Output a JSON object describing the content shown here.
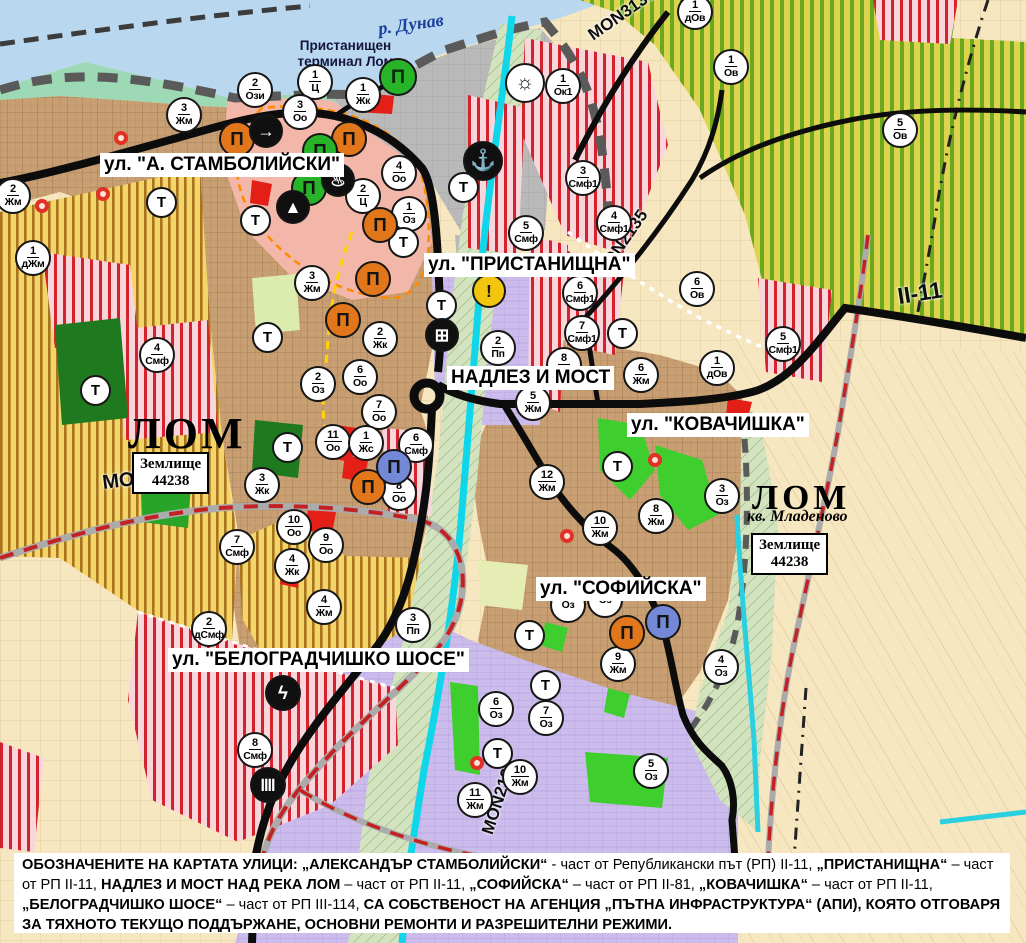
{
  "map": {
    "labels": {
      "river": "р. Дунав",
      "terminal": "Пристанищен\nтерминал Лом",
      "lom_left": "ЛОМ",
      "lom_right": "ЛОМ",
      "kvartal": "кв. Младеново"
    },
    "land_unit": {
      "line1": "Землище",
      "line2": "44238"
    },
    "land_unit_boxes": [
      {
        "x": 132,
        "y": 452
      },
      {
        "x": 751,
        "y": 533
      }
    ],
    "street_labels": [
      {
        "text": "ул. \"А. СТАМБОЛИЙСКИ\"",
        "x": 100,
        "y": 153
      },
      {
        "text": "ул. \"ПРИСТАНИЩНА\"",
        "x": 424,
        "y": 253
      },
      {
        "text": "НАДЛЕЗ И МОСТ",
        "x": 447,
        "y": 366
      },
      {
        "text": "ул. \"КОВАЧИШКА\"",
        "x": 627,
        "y": 413
      },
      {
        "text": "ул. \"СОФИЙСКА\"",
        "x": 536,
        "y": 577
      },
      {
        "text": "ул. \"БЕЛОГРАДЧИШКО ШОСЕ\"",
        "x": 168,
        "y": 648
      }
    ],
    "road_labels": [
      {
        "text": "MON3138",
        "x": 596,
        "y": 46,
        "rot": -35,
        "size": 17
      },
      {
        "text": "MON2135",
        "x": 608,
        "y": 282,
        "rot": -55,
        "size": 17
      },
      {
        "text": "MON3139",
        "x": 104,
        "y": 496,
        "rot": -7,
        "size": 20
      },
      {
        "text": "II-11",
        "x": 900,
        "y": 310,
        "rot": -9,
        "size": 23
      },
      {
        "text": "MON2136",
        "x": 497,
        "y": 838,
        "rot": -72,
        "size": 17
      }
    ],
    "transport_marker_label": "Т",
    "transport_markers": [
      [
        161,
        202
      ],
      [
        255,
        220
      ],
      [
        403,
        242
      ],
      [
        463,
        187
      ],
      [
        441,
        305
      ],
      [
        622,
        333
      ],
      [
        267,
        337
      ],
      [
        95,
        390
      ],
      [
        287,
        447
      ],
      [
        617,
        466
      ],
      [
        529,
        635
      ],
      [
        545,
        685
      ],
      [
        497,
        753
      ]
    ],
    "zone_markers": [
      {
        "n": "2",
        "c": "Жм",
        "x": 13,
        "y": 196
      },
      {
        "n": "1",
        "c": "дЖм",
        "x": 33,
        "y": 258
      },
      {
        "n": "3",
        "c": "Жм",
        "x": 184,
        "y": 115
      },
      {
        "n": "2",
        "c": "Ози",
        "x": 255,
        "y": 90
      },
      {
        "n": "1",
        "c": "Ц",
        "x": 315,
        "y": 82
      },
      {
        "n": "1",
        "c": "Жк",
        "x": 363,
        "y": 95
      },
      {
        "n": "3",
        "c": "Оо",
        "x": 300,
        "y": 112
      },
      {
        "n": "2",
        "c": "Ц",
        "x": 363,
        "y": 196
      },
      {
        "n": "4",
        "c": "Оо",
        "x": 399,
        "y": 173
      },
      {
        "n": "1",
        "c": "Оз",
        "x": 409,
        "y": 214
      },
      {
        "n": "1",
        "c": "Ок1",
        "x": 563,
        "y": 86
      },
      {
        "n": "3",
        "c": "Смф1",
        "x": 583,
        "y": 178
      },
      {
        "n": "4",
        "c": "Смф1",
        "x": 614,
        "y": 223
      },
      {
        "n": "1",
        "c": "дОв",
        "x": 695,
        "y": 12
      },
      {
        "n": "1",
        "c": "Ов",
        "x": 731,
        "y": 67
      },
      {
        "n": "5",
        "c": "Ов",
        "x": 900,
        "y": 130
      },
      {
        "n": "5",
        "c": "Смф",
        "x": 526,
        "y": 233
      },
      {
        "n": "6",
        "c": "Смф1",
        "x": 580,
        "y": 293
      },
      {
        "n": "7",
        "c": "Смф1",
        "x": 582,
        "y": 333
      },
      {
        "n": "6",
        "c": "Ов",
        "x": 697,
        "y": 289
      },
      {
        "n": "5",
        "c": "Смф1",
        "x": 783,
        "y": 344
      },
      {
        "n": "2",
        "c": "Пп",
        "x": 498,
        "y": 348
      },
      {
        "n": "3",
        "c": "Жм",
        "x": 312,
        "y": 283
      },
      {
        "n": "2",
        "c": "Жк",
        "x": 380,
        "y": 339
      },
      {
        "n": "2",
        "c": "Оз",
        "x": 318,
        "y": 384
      },
      {
        "n": "6",
        "c": "Оо",
        "x": 360,
        "y": 377
      },
      {
        "n": "7",
        "c": "Оо",
        "x": 379,
        "y": 412
      },
      {
        "n": "11",
        "c": "Оо",
        "x": 333,
        "y": 442
      },
      {
        "n": "1",
        "c": "Жс",
        "x": 366,
        "y": 443
      },
      {
        "n": "6",
        "c": "Смф",
        "x": 416,
        "y": 445
      },
      {
        "n": "8",
        "c": "Оо",
        "x": 399,
        "y": 493
      },
      {
        "n": "3",
        "c": "Жк",
        "x": 262,
        "y": 485
      },
      {
        "n": "10",
        "c": "Оо",
        "x": 294,
        "y": 527
      },
      {
        "n": "9",
        "c": "Оо",
        "x": 326,
        "y": 545
      },
      {
        "n": "7",
        "c": "Смф",
        "x": 237,
        "y": 547
      },
      {
        "n": "4",
        "c": "Жк",
        "x": 292,
        "y": 566
      },
      {
        "n": "4",
        "c": "Жм",
        "x": 324,
        "y": 607
      },
      {
        "n": "2",
        "c": "дСмф",
        "x": 209,
        "y": 629
      },
      {
        "n": "3",
        "c": "Пп",
        "x": 413,
        "y": 625
      },
      {
        "n": "4",
        "c": "Смф",
        "x": 157,
        "y": 355
      },
      {
        "n": "8",
        "c": "Смф",
        "x": 255,
        "y": 750
      },
      {
        "n": "8",
        "c": "Жм",
        "x": 564,
        "y": 365
      },
      {
        "n": "5",
        "c": "Жм",
        "x": 533,
        "y": 403
      },
      {
        "n": "6",
        "c": "Жм",
        "x": 641,
        "y": 375
      },
      {
        "n": "12",
        "c": "Жм",
        "x": 547,
        "y": 482
      },
      {
        "n": "8",
        "c": "Жм",
        "x": 656,
        "y": 516
      },
      {
        "n": "10",
        "c": "Жм",
        "x": 600,
        "y": 528
      },
      {
        "n": "3",
        "c": "Оз",
        "x": 722,
        "y": 496
      },
      {
        "n": "1",
        "c": "дОв",
        "x": 717,
        "y": 368
      },
      {
        "n": "",
        "c": "Оз",
        "x": 568,
        "y": 605
      },
      {
        "n": "",
        "c": "Оз",
        "x": 605,
        "y": 600
      },
      {
        "n": "9",
        "c": "Жм",
        "x": 618,
        "y": 664
      },
      {
        "n": "4",
        "c": "Оз",
        "x": 721,
        "y": 667
      },
      {
        "n": "6",
        "c": "Оз",
        "x": 496,
        "y": 709
      },
      {
        "n": "7",
        "c": "Оз",
        "x": 546,
        "y": 718
      },
      {
        "n": "10",
        "c": "Жм",
        "x": 520,
        "y": 777
      },
      {
        "n": "11",
        "c": "Жм",
        "x": 475,
        "y": 800
      },
      {
        "n": "5",
        "c": "Оз",
        "x": 651,
        "y": 771
      }
    ],
    "icon_markers": [
      {
        "name": "port-facility-icon",
        "g": "Π",
        "bg": "#28b428",
        "fg": "#0b2d0b",
        "x": 398,
        "y": 77,
        "d": 38
      },
      {
        "name": "anchor-icon",
        "g": "⚓",
        "bg": "#101010",
        "fg": "#ffffff",
        "x": 483,
        "y": 161,
        "d": 40
      },
      {
        "name": "beach-sun-icon",
        "g": "☼",
        "bg": "#ffffff",
        "fg": "#101010",
        "x": 525,
        "y": 83,
        "d": 40
      },
      {
        "name": "landmark-icon",
        "g": "Π",
        "bg": "#e2761b",
        "fg": "#141414",
        "x": 237,
        "y": 139,
        "d": 36
      },
      {
        "name": "landmark-icon",
        "g": "Π",
        "bg": "#e2761b",
        "fg": "#141414",
        "x": 349,
        "y": 139,
        "d": 36
      },
      {
        "name": "landmark-icon",
        "g": "Π",
        "bg": "#e2761b",
        "fg": "#141414",
        "x": 380,
        "y": 225,
        "d": 36
      },
      {
        "name": "landmark-icon",
        "g": "Π",
        "bg": "#e2761b",
        "fg": "#141414",
        "x": 373,
        "y": 279,
        "d": 36
      },
      {
        "name": "landmark-icon",
        "g": "Π",
        "bg": "#e2761b",
        "fg": "#141414",
        "x": 343,
        "y": 320,
        "d": 36
      },
      {
        "name": "landmark-icon",
        "g": "Π",
        "bg": "#e2761b",
        "fg": "#141414",
        "x": 368,
        "y": 487,
        "d": 36
      },
      {
        "name": "landmark-icon",
        "g": "Π",
        "bg": "#e2761b",
        "fg": "#141414",
        "x": 627,
        "y": 633,
        "d": 36
      },
      {
        "name": "landmark-green-icon",
        "g": "Π",
        "bg": "#28b428",
        "fg": "#141414",
        "x": 320,
        "y": 151,
        "d": 36
      },
      {
        "name": "landmark-green-icon",
        "g": "Π",
        "bg": "#28b428",
        "fg": "#141414",
        "x": 309,
        "y": 188,
        "d": 36
      },
      {
        "name": "landmark-blue-icon",
        "g": "Π",
        "bg": "#7388d6",
        "fg": "#141414",
        "x": 394,
        "y": 467,
        "d": 36
      },
      {
        "name": "landmark-blue-icon",
        "g": "Π",
        "bg": "#7388d6",
        "fg": "#141414",
        "x": 663,
        "y": 622,
        "d": 36
      },
      {
        "name": "gate-icon",
        "g": "→",
        "bg": "#101010",
        "fg": "#ffffff",
        "x": 266,
        "y": 131,
        "d": 34
      },
      {
        "name": "fountain-icon",
        "g": "♨",
        "bg": "#101010",
        "fg": "#ffffff",
        "x": 338,
        "y": 180,
        "d": 34
      },
      {
        "name": "monument-icon",
        "g": "▲",
        "bg": "#101010",
        "fg": "#ffffff",
        "x": 293,
        "y": 207,
        "d": 34
      },
      {
        "name": "warning-icon",
        "g": "!",
        "bg": "#f2c50e",
        "fg": "#141414",
        "x": 489,
        "y": 291,
        "d": 34
      },
      {
        "name": "truck-icon",
        "g": "⊞",
        "bg": "#101010",
        "fg": "#ffffff",
        "x": 442,
        "y": 335,
        "d": 34
      },
      {
        "name": "power-icon",
        "g": "ϟ",
        "bg": "#101010",
        "fg": "#ffffff",
        "x": 283,
        "y": 693,
        "d": 36
      },
      {
        "name": "rail-station-icon",
        "g": "≣",
        "bg": "#101010",
        "fg": "#ffffff",
        "x": 268,
        "y": 785,
        "d": 36,
        "rot": 90
      }
    ],
    "red_dots": [
      [
        121,
        138
      ],
      [
        103,
        194
      ],
      [
        42,
        206
      ],
      [
        655,
        460
      ],
      [
        477,
        763
      ],
      [
        567,
        536
      ]
    ],
    "footer_segments": [
      {
        "t": "ОБОЗНАЧЕНИТЕ НА КАРТАТА УЛИЦИ: „АЛЕКСАНДЪР СТАМБОЛИЙСКИ“",
        "b": true
      },
      {
        "t": " - част от Републикански път (РП) II-11, ",
        "b": false
      },
      {
        "t": "„ПРИСТАНИЩНА“",
        "b": true
      },
      {
        "t": " – част от РП II-11, ",
        "b": false
      },
      {
        "t": "НАДЛЕЗ И МОСТ НАД РЕКА ЛОМ",
        "b": true
      },
      {
        "t": " – част от РП II-11, ",
        "b": false
      },
      {
        "t": "„СОФИЙСКА“",
        "b": true
      },
      {
        "t": " – част от РП II-81, ",
        "b": false
      },
      {
        "t": "„КОВАЧИШКА“",
        "b": true
      },
      {
        "t": " – част от РП II-11, ",
        "b": false
      },
      {
        "t": "„БЕЛОГРАДЧИШКО ШОСЕ“",
        "b": true
      },
      {
        "t": " – част от РП III-114, ",
        "b": false
      },
      {
        "t": "СА СОБСТВЕНОСТ НА АГЕНЦИЯ „ПЪТНА ИНФРАСТРУКТУРА“ (АПИ), КОЯТО ОТГОВАРЯ ЗА ТЯХНОТО ТЕКУЩО ПОДДЪРЖАНЕ, ОСНОВНИ РЕМОНТИ И РАЗРЕШИТЕЛНИ РЕЖИМИ.",
        "b": true
      }
    ],
    "colors": {
      "danube": "#b9d7ee",
      "river_lom": "#10d6ea",
      "residential": "#c89f73",
      "villa_striped": "#f4d569",
      "vineyard": "#dcd44e",
      "mixed_smf": "#d4232c",
      "production": "#ccbcec",
      "park": "#3ecf2e",
      "central": "#f3b7a9",
      "port": "#b9b9b9",
      "road": "#0c0c0c",
      "rail": "#c32222"
    }
  }
}
